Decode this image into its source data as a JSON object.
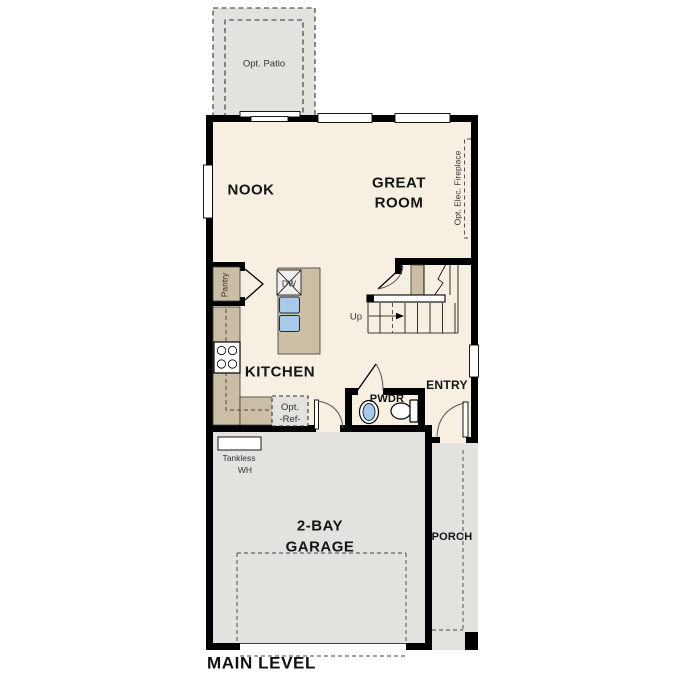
{
  "plan_title": "MAIN LEVEL",
  "colors": {
    "floor": "#f6efe2",
    "optional_area": "#e3e2df",
    "cabinet": "#cbbea4",
    "fixture_blue": "#a9c9e9",
    "wall": "#000000"
  },
  "labels": {
    "patio": "Opt. Patio",
    "nook": "NOOK",
    "great_room_line1": "GREAT",
    "great_room_line2": "ROOM",
    "fireplace": "Opt. Elec. Fireplace",
    "pantry": "Pantry",
    "dishwasher": "DW",
    "stairs_up": "Up",
    "kitchen": "KITCHEN",
    "opt_ref_line1": "Opt.",
    "opt_ref_line2": "-Ref-",
    "powder": "PWDR",
    "entry": "ENTRY",
    "tankless_line1": "Tankless",
    "tankless_line2": "WH",
    "garage_line1": "2-BAY",
    "garage_line2": "GARAGE",
    "porch": "PORCH"
  }
}
